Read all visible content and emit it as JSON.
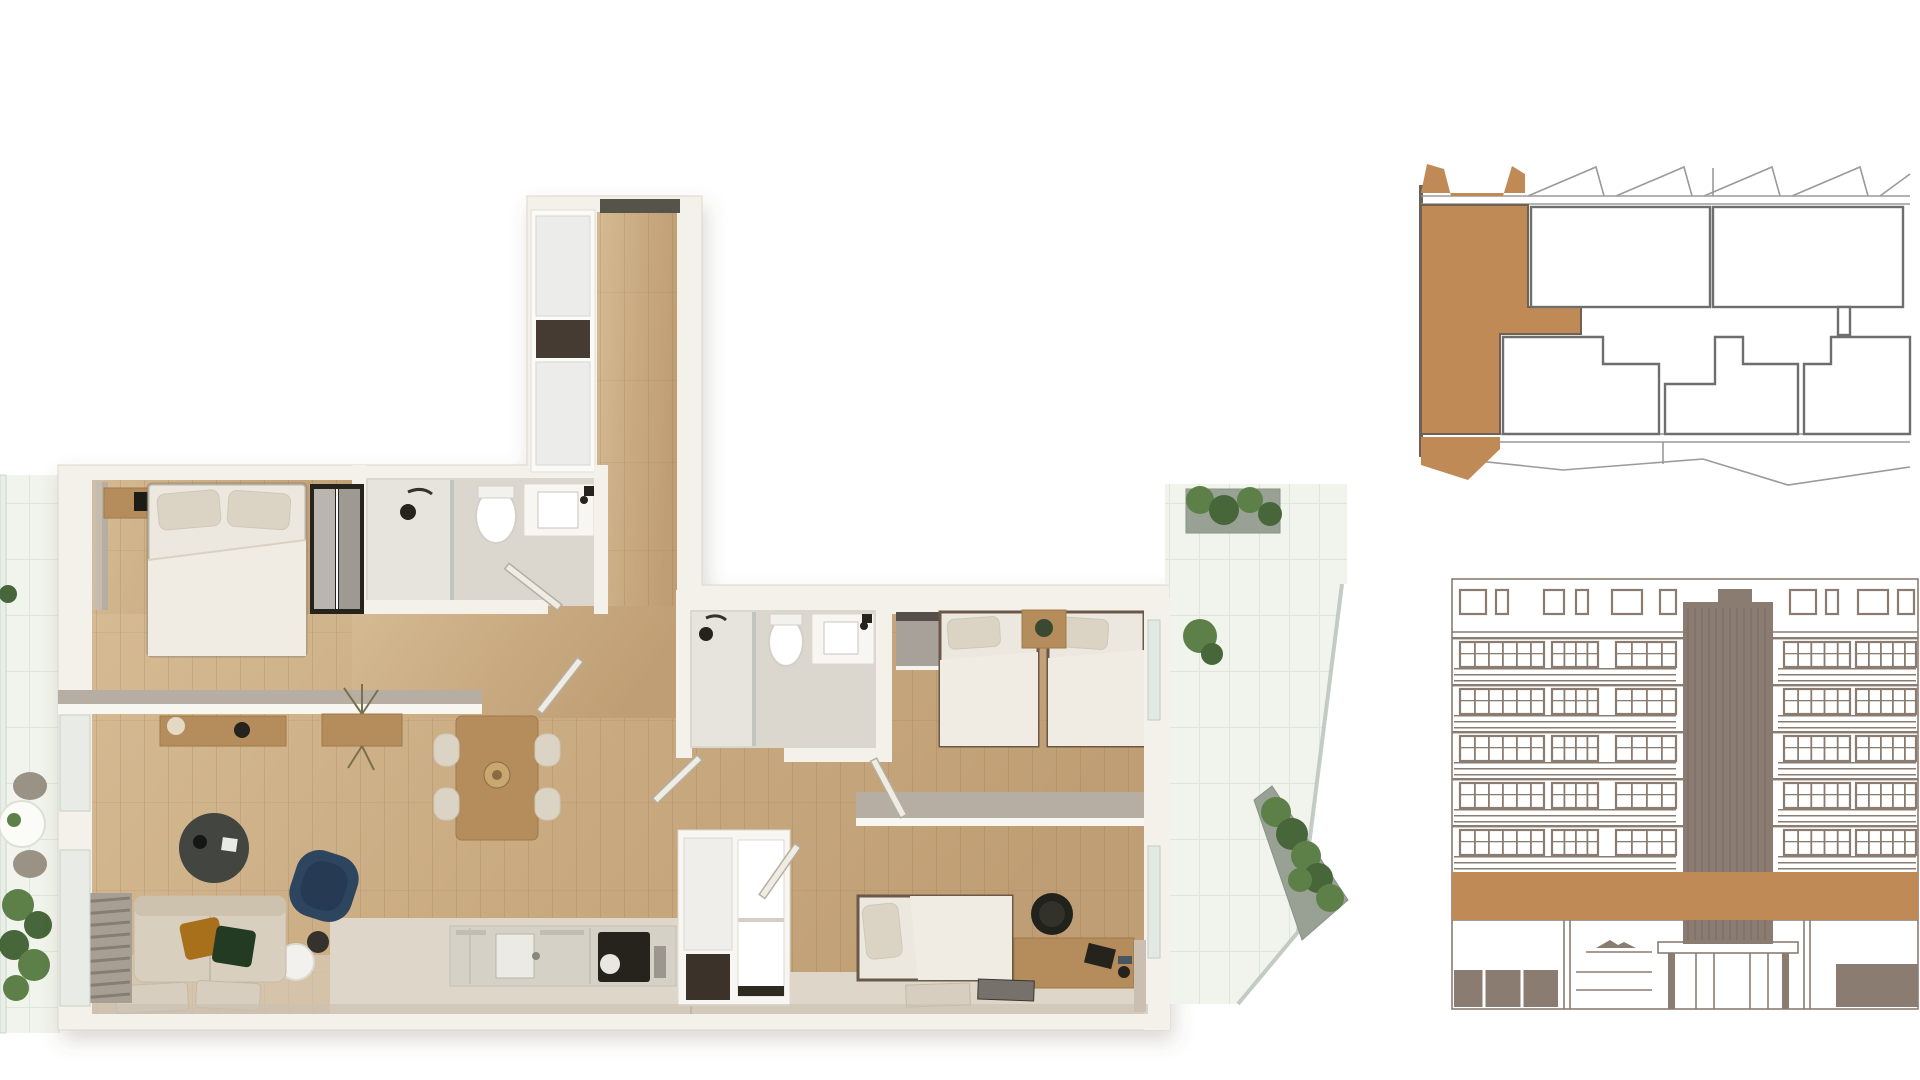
{
  "meta": {
    "type": "architectural-real-estate-visualization",
    "views": [
      "3d-floor-plan-top-view",
      "building-key-plan",
      "building-front-elevation"
    ],
    "visible_text": "none"
  },
  "colors": {
    "accent_brown": "#c08a57",
    "elevation_taupe": "#8b7c72",
    "elevation_taupe_dark": "#7a6c62",
    "keyplan_line": "#9a9a9a",
    "keyplan_unit_border": "#6e6e6e",
    "wall": "#f3f1ea",
    "wall_edge": "#dcd7cb",
    "wall_cut_top": "#b6aea2",
    "wall_inner_face": "#cabfb0",
    "wood_light": "#d8bf9a",
    "wood_dark": "#bd9c72",
    "tile_bath": "#dbd7cf",
    "tile_shower": "#e7e4de",
    "floor_stone": "#ded7c9",
    "tile_balcony": "#f1f4ed",
    "tile_balcony_line": "#dfe7dc",
    "glass": "#b8c3bb",
    "planter_gray": "#99a195",
    "plant_green": "#5d8049",
    "plant_green_dark": "#47663a",
    "bed_linen": "#ece8df",
    "pillow": "#dbd4c5",
    "blanket": "#e2dccf",
    "sofa_beige": "#d8cfbf",
    "cushion_orange": "#a9701e",
    "cushion_green": "#233a20",
    "navy_chair": "#2e4460",
    "furniture_wood": "#b58c5c",
    "dark_object": "#26231f",
    "furniture_white": "#f7f6f2",
    "kitchen_counter": "#d6d1c6",
    "rug": "#d7cec0"
  },
  "floor_plan": {
    "style": "photoreal top-down 3d render",
    "rooms": [
      {
        "name": "entrance-hall",
        "features": [
          "entry-door",
          "built-in-wardrobe",
          "dark-shelf-niche",
          "wood-floor"
        ]
      },
      {
        "name": "bedroom-1",
        "features": [
          "double-bed",
          "nightstand-tv",
          "sliding-wardrobe",
          "half-wall-to-living"
        ]
      },
      {
        "name": "bathroom-1",
        "features": [
          "walk-in-shower",
          "toilet",
          "vanity-sink",
          "open-door"
        ]
      },
      {
        "name": "living-dining",
        "features": [
          "sideboard-with-lamp",
          "planter-box",
          "dining-table-4-chairs",
          "round-coffee-table",
          "navy-lounge-chair",
          "sphere-floor-lamp",
          "beige-sofa-2-cushions",
          "two-rugs",
          "louver-bench"
        ]
      },
      {
        "name": "kitchen",
        "features": [
          "counter-run",
          "sink",
          "black-cooktop",
          "tall-cabinet",
          "storage-unit-dark-niche"
        ]
      },
      {
        "name": "bathroom-2",
        "features": [
          "walk-in-shower",
          "toilet",
          "vanity-sink",
          "open-door"
        ]
      },
      {
        "name": "bedroom-2",
        "features": [
          "twin-bed",
          "twin-bed",
          "nightstand-plant",
          "open-closet"
        ]
      },
      {
        "name": "bedroom-3",
        "features": [
          "single-bed",
          "desk-with-chair",
          "two-mats",
          "open-shelf-unit"
        ]
      },
      {
        "name": "balcony-left",
        "features": [
          "white-tiles",
          "round-table-two-chairs",
          "plants"
        ]
      },
      {
        "name": "terrace-top-right",
        "features": [
          "white-tiles",
          "planter-with-greenery"
        ]
      },
      {
        "name": "balcony-right-angled",
        "features": [
          "white-tiles",
          "glass-balustrade",
          "long-planter-with-greenery",
          "diagonal-corner"
        ]
      }
    ]
  },
  "key_plan": {
    "description": "floor plate schematic, current unit filled in brown at left end",
    "highlighted_unit": {
      "position": "left",
      "shape": "L-with-terrace-flaps",
      "fill": "#c08a57"
    },
    "other_units_visible": 5,
    "sawtooth_terrace_edge": true,
    "teeth_x": [
      115,
      203,
      291,
      379,
      467
    ],
    "corridor_band": true
  },
  "elevation": {
    "description": "front facade line drawing, unit floor highlighted with brown band, central striped core tower",
    "window_floors": 5,
    "floor_ys": [
      65,
      112,
      159,
      206,
      253
    ],
    "railing_spans": [
      [
        8,
        230
      ],
      [
        332,
        470
      ]
    ],
    "window_groups": [
      [
        14,
        84,
        5
      ],
      [
        106,
        46,
        3
      ],
      [
        170,
        60,
        3
      ],
      [
        338,
        66,
        4
      ],
      [
        410,
        60,
        4
      ]
    ],
    "parapet_windows": [
      [
        14,
        26
      ],
      [
        50,
        12
      ],
      [
        98,
        20
      ],
      [
        130,
        12
      ],
      [
        166,
        30
      ],
      [
        214,
        16
      ],
      [
        344,
        26
      ],
      [
        380,
        12
      ],
      [
        412,
        30
      ],
      [
        452,
        16
      ]
    ],
    "tower": {
      "x": 237,
      "w": 90,
      "top": 30,
      "bottom": 372,
      "cap_x": 272,
      "cap_w": 34
    },
    "highlight_band": {
      "y": 300,
      "h": 48
    },
    "ground_floor": {
      "y": 348,
      "bottom": 437,
      "entrance_canopy": true,
      "logo_mark": "mountain"
    }
  }
}
